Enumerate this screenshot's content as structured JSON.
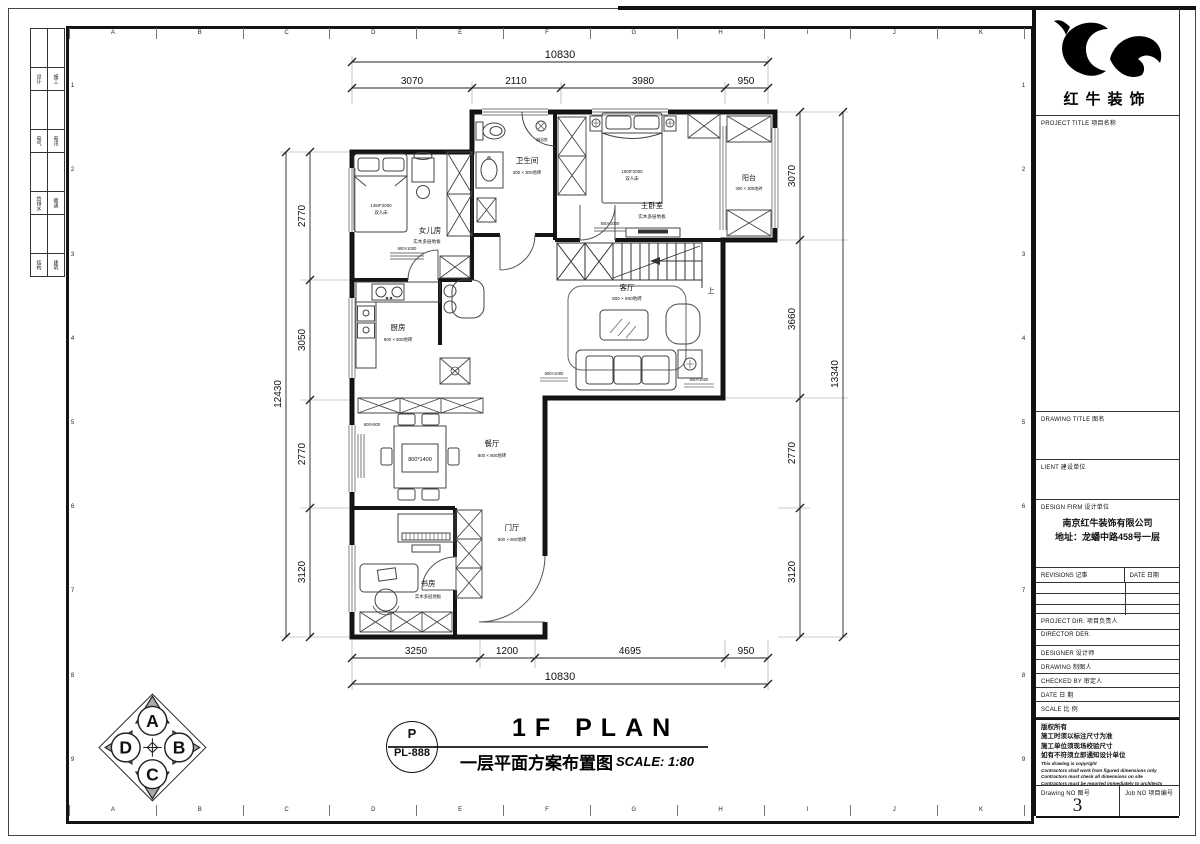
{
  "sheet": {
    "grid_letters": [
      "A",
      "B",
      "C",
      "D",
      "E",
      "F",
      "G",
      "H",
      "I",
      "J",
      "K"
    ],
    "grid_numbers": [
      "1",
      "2",
      "3",
      "4",
      "5",
      "6",
      "7",
      "8",
      "9"
    ],
    "signature_strip": [
      [
        "设计",
        "施工"
      ],
      [
        "电气",
        "电讯"
      ],
      [
        "给排水",
        "暖通"
      ],
      [
        "结构",
        "建筑"
      ]
    ]
  },
  "title_block": {
    "brand": "红牛装饰",
    "project_title": "PROJECT TITLE  项目名称",
    "drawing_title": "DRAWING TITLE  图名",
    "client": "LIENT  建设单位",
    "design_firm": "DESIGN FIRM  设计单位",
    "firm_name": "南京红牛装饰有限公司",
    "firm_address": "地址：龙蟠中路458号一层",
    "revisions": "REVISIONS  记事",
    "date_col": "DATE  日期",
    "project_dir": "PROJECT DIR.  项目负责人",
    "director": "DIRECTOR DER.",
    "designer": "DESIGNER    设计师",
    "drawing_by": "DRAWING    制图人",
    "checked_by": "CHECKED BY  审定人",
    "date": "DATE        日  期",
    "scale": "SCALE       比  例",
    "copyright_cn": [
      "版权所有",
      "施工时须以标注尺寸为准",
      "施工单位须现场校验尺寸",
      "如有不符须立即通知设计单位"
    ],
    "copyright_en": [
      "This drawing is copyright",
      "Contractors shall work from figured dimensions only",
      "Contractors must check all dimensions on site",
      "Contractors must be reported immediately to architects"
    ],
    "drawing_no_label": "Drawing NO  图号",
    "drawing_no": "3",
    "job_no_label": "Job NO  项目编号"
  },
  "plan": {
    "rooms": {
      "bathroom": {
        "name": "卫生间",
        "floor": "300 × 300地砖"
      },
      "master": {
        "name": "主卧室",
        "floor": "实木多层地板"
      },
      "balcony": {
        "name": "阳台",
        "floor": "300 × 300地砖"
      },
      "daughter": {
        "name": "女儿房",
        "floor": "实木多层地板"
      },
      "kitchen": {
        "name": "厨房",
        "floor": "800 × 800地砖"
      },
      "living": {
        "name": "客厅",
        "floor": "800 × 800地砖"
      },
      "dining": {
        "name": "餐厅",
        "floor": "800 × 800地砖"
      },
      "foyer": {
        "name": "门厅",
        "floor": "800 × 800地砖"
      },
      "study": {
        "name": "书房",
        "floor": "实木多层地板"
      }
    },
    "annotations": {
      "bed_master": "1500*2000",
      "bed_daughter": "1350*2000",
      "double_bed": "双人床",
      "dining_table": "800*1400",
      "rug1": "600×1000",
      "rug2": "600×800",
      "shower": "淋浴房",
      "up": "上"
    },
    "dims": {
      "top_total": "10830",
      "top": [
        "3070",
        "2110",
        "3980",
        "950"
      ],
      "bottom": [
        "3250",
        "1200",
        "4695",
        "950"
      ],
      "bottom_total": "10830",
      "left": [
        "2770",
        "3050",
        "2770",
        "3120"
      ],
      "left_total": "12430",
      "right": [
        "3070",
        "3660",
        "2770",
        "3120"
      ],
      "right_total": "13340"
    }
  },
  "footer": {
    "compass": [
      "A",
      "B",
      "C",
      "D"
    ],
    "bubble_top": "P",
    "bubble_code": "PL-888",
    "title_en": "1F PLAN",
    "title_cn": "一层平面方案布置图",
    "scale_note": "SCALE:  1:80"
  }
}
